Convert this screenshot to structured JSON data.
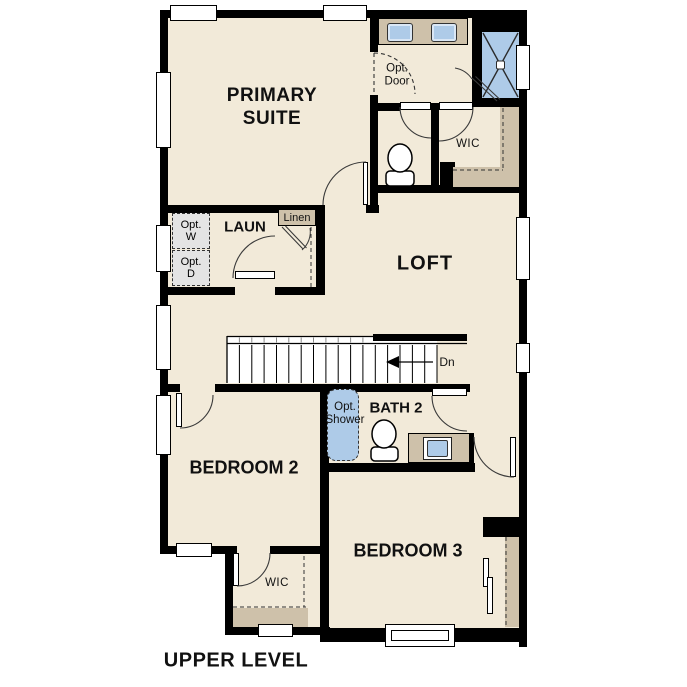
{
  "title": "UPPER LEVEL",
  "rooms": {
    "primary_suite": {
      "line1": "PRIMARY",
      "line2": "SUITE"
    },
    "laundry": "LAUN",
    "loft": "LOFT",
    "wic_upper": "WIC",
    "bath2": "BATH 2",
    "bedroom2": "BEDROOM 2",
    "bedroom3": "BEDROOM 3",
    "wic_lower": "WIC"
  },
  "fixtures": {
    "linen": "Linen",
    "opt_washer": {
      "line1": "Opt.",
      "line2": "W"
    },
    "opt_dryer": {
      "line1": "Opt.",
      "line2": "D"
    },
    "opt_door": {
      "line1": "Opt.",
      "line2": "Door"
    },
    "opt_shower": {
      "line1": "Opt.",
      "line2": "Shower"
    },
    "stairs_direction": "Dn"
  },
  "colors": {
    "floor": "#f2ead9",
    "wall": "#000000",
    "fixture_blue": "#aecbe8",
    "cabinet_tan": "#cec1aa",
    "optional_gray": "#e4e4e4"
  }
}
